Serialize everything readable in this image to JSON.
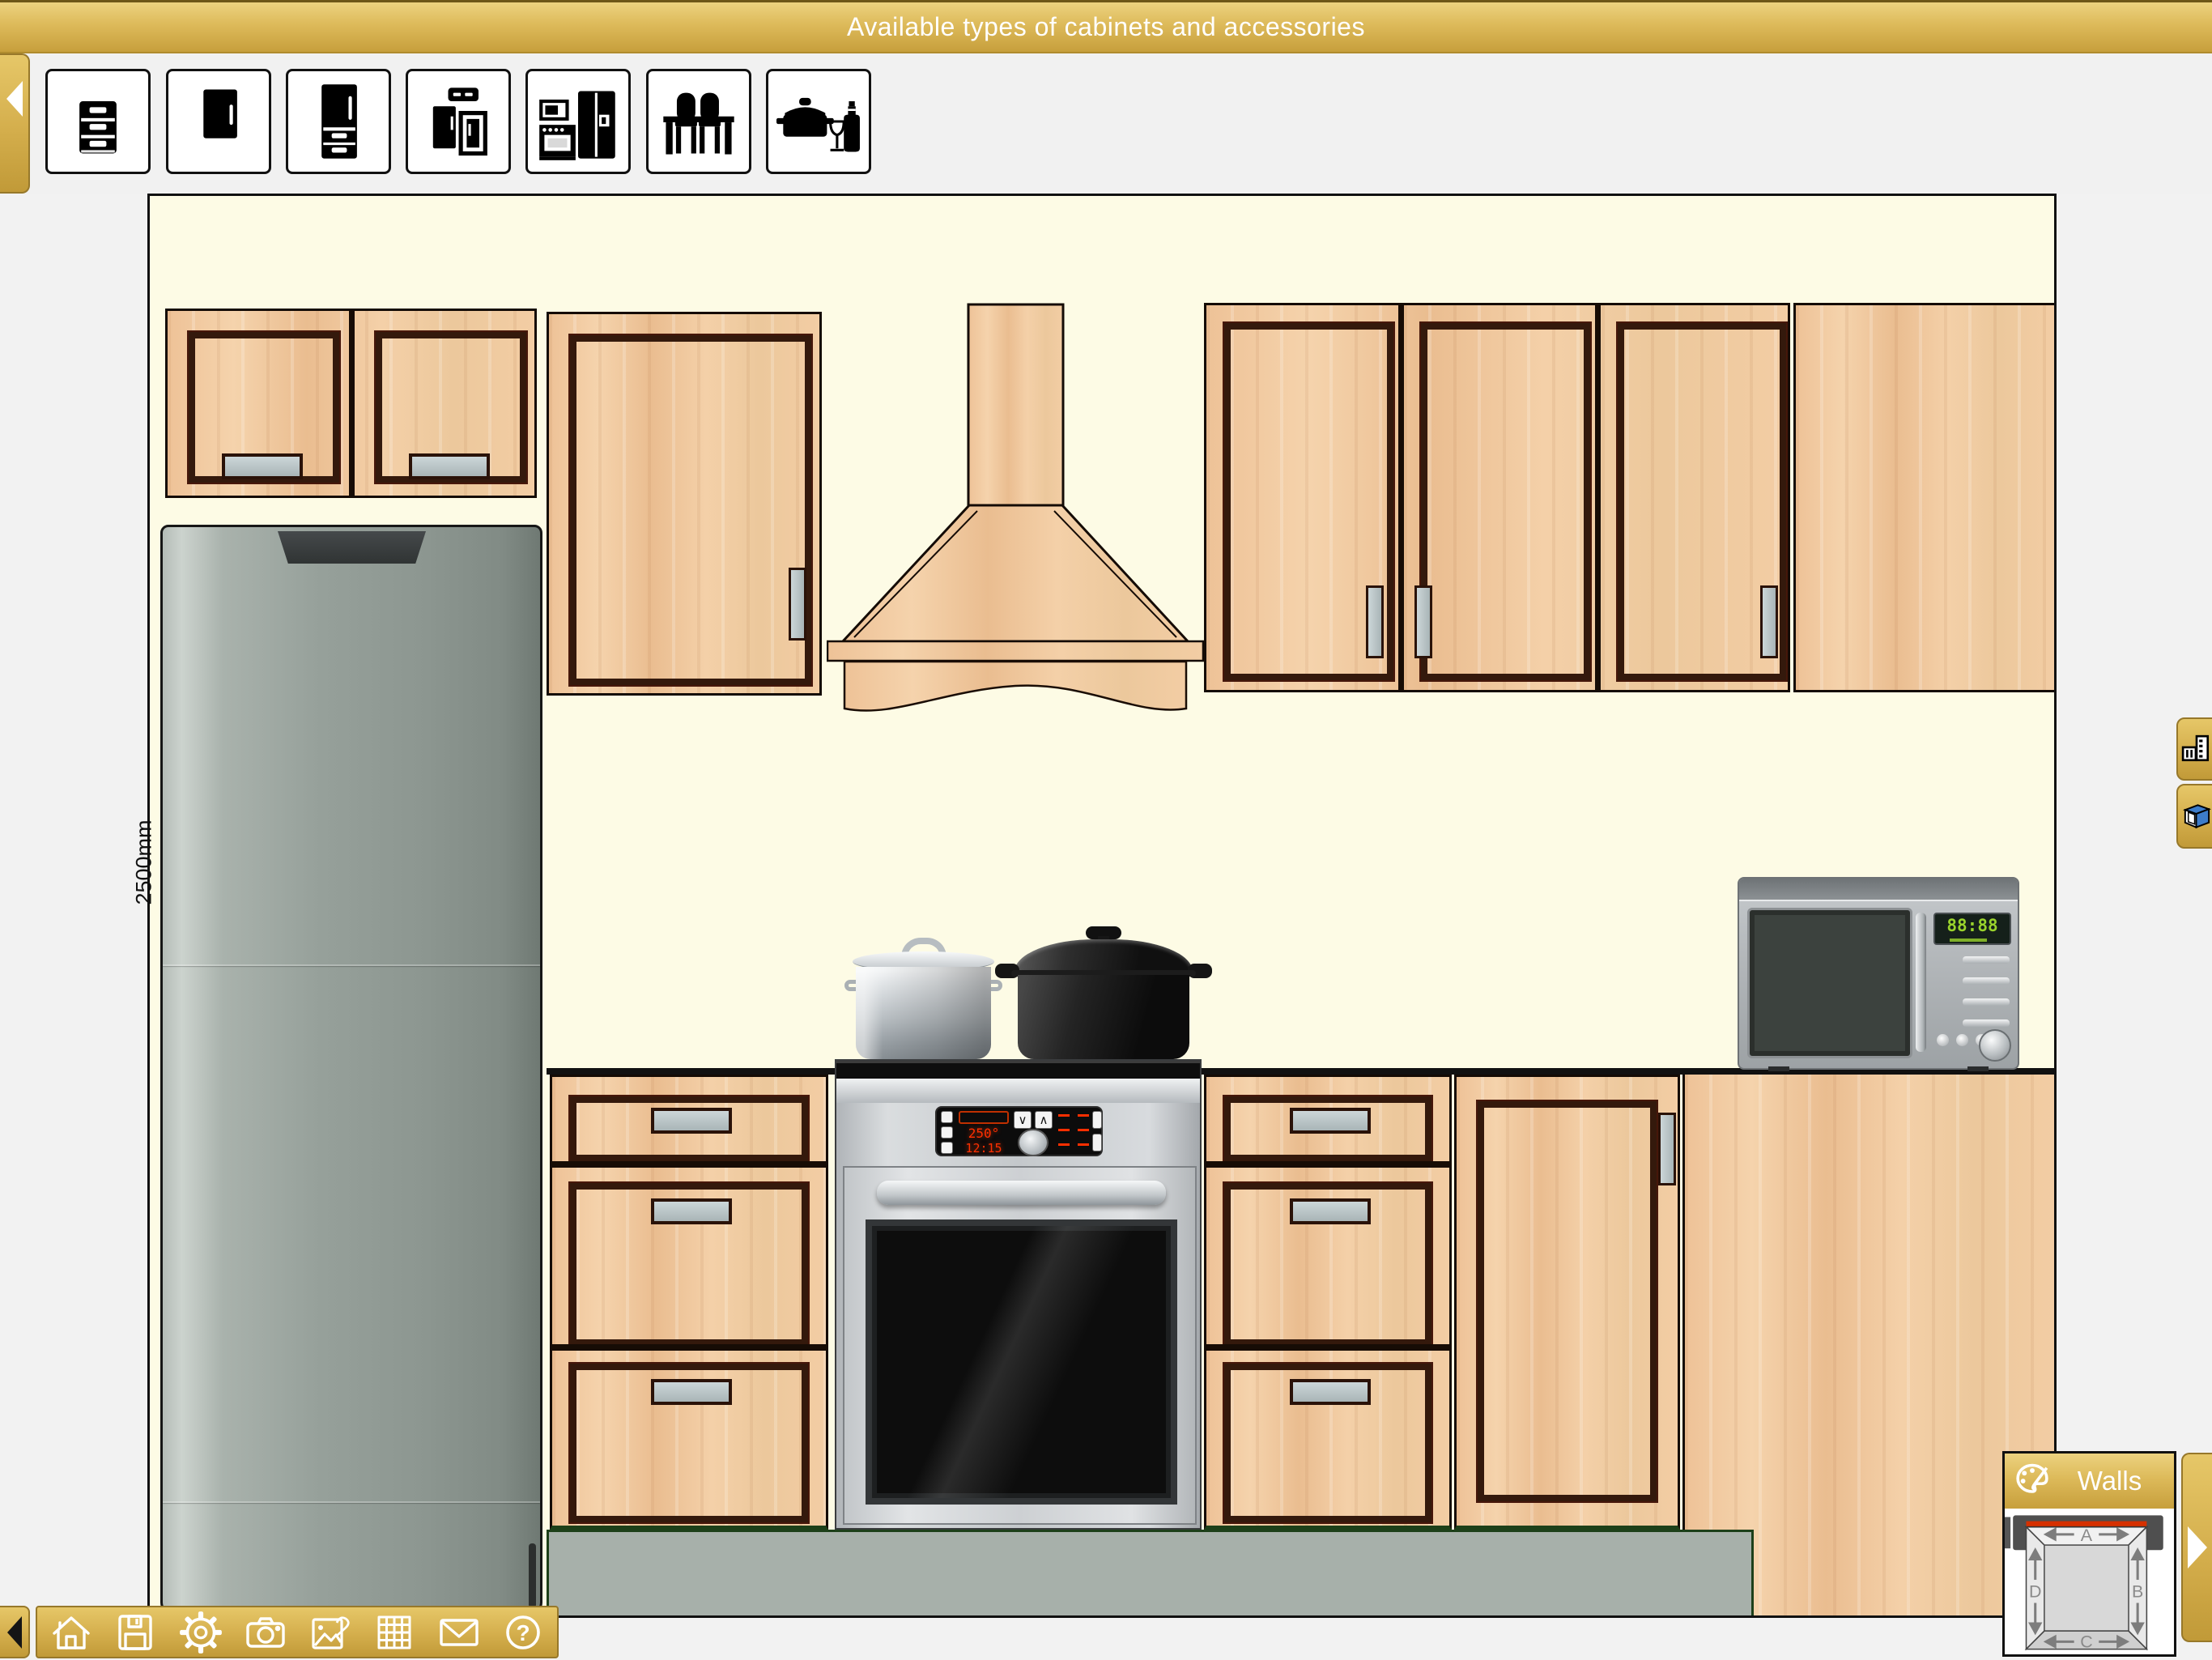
{
  "title_bar": {
    "title": "Available types of cabinets and accessories"
  },
  "cabinet_palette": {
    "items": [
      {
        "icon": "drawer-base-cabinet-icon"
      },
      {
        "icon": "wall-cabinet-icon"
      },
      {
        "icon": "tall-cabinet-icon"
      },
      {
        "icon": "cabinet-set-icon"
      },
      {
        "icon": "appliances-icon"
      },
      {
        "icon": "dining-set-icon"
      },
      {
        "icon": "cookware-accessories-icon"
      }
    ]
  },
  "canvas": {
    "dimension_label": "2500mm"
  },
  "appliances": {
    "oven_display": {
      "temperature": "250°",
      "time": "12:15"
    },
    "microwave_display": "88:88"
  },
  "walls_panel": {
    "title": "Walls",
    "labels": {
      "top": "A",
      "right": "B",
      "bottom": "C",
      "left": "D"
    }
  },
  "toolbar": {
    "help_glyph": "?"
  },
  "colors": {
    "gold": "#d3ab47",
    "canvas_bg": "#fdfbe5",
    "wood": "#f0c89e",
    "frame_brown": "#34190c",
    "plinth_gray": "#a7b0aa",
    "accent_green": "#1d4019",
    "selection_red": "#d63000",
    "display_red": "#ff2f00",
    "display_green": "#9ad32c"
  }
}
